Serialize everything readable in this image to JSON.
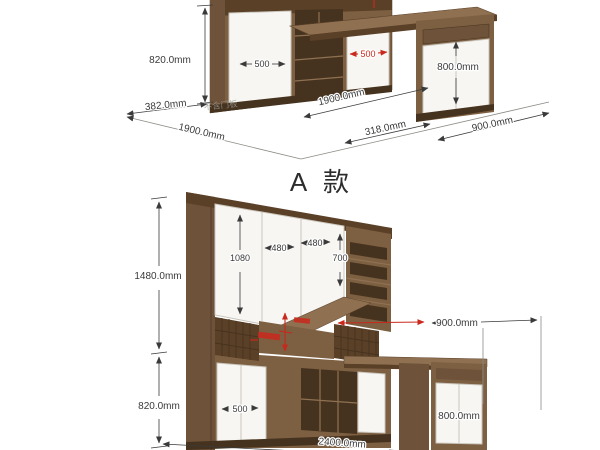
{
  "title": "A 款",
  "colors": {
    "background": "#ffffff",
    "wood": "#7d5f42",
    "wood_mid": "#6e523a",
    "wood_dark": "#5b4028",
    "wood_deep": "#46331f",
    "wood_light": "#8f7152",
    "panel": "#f7f6f2",
    "panel_border": "#c9c5bc",
    "dim": "#3a3a3a",
    "dim_red": "#c9281c",
    "floor_line": "#8a8a84",
    "note": "#9a9a92"
  },
  "top_drawing": {
    "height": "820.0mm",
    "door_width": "500",
    "door_width_red": "500",
    "right_cabinet_height": "800.0mm",
    "depth": "382.0mm",
    "depth_note": "不含门板",
    "width_front": "1900.0mm",
    "width_back": "1900.0mm",
    "desk_depth": "318.0mm",
    "desk_width": "900.0mm"
  },
  "bottom_drawing": {
    "total_height": "1480.0mm",
    "upper_door_height": "1080",
    "upper_door_width_left": "480",
    "upper_door_width_right": "480",
    "side_shelf_height": "700",
    "desk_width": "900.0mm",
    "lower_height": "820.0mm",
    "lower_door_width": "500",
    "total_width": "2400.0mm",
    "desk_cabinet_height": "800.0mm"
  }
}
